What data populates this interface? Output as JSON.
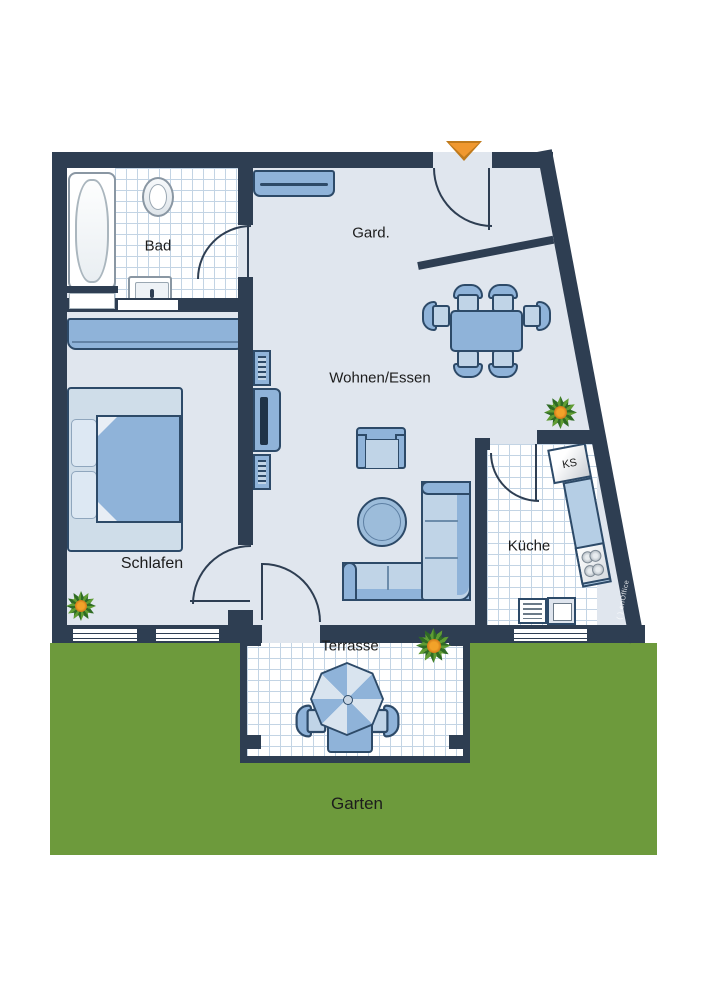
{
  "rooms": [
    {
      "id": "bad",
      "label": "Bad"
    },
    {
      "id": "gard",
      "label": "Gard."
    },
    {
      "id": "wohnen-essen",
      "label": "Wohnen/Essen"
    },
    {
      "id": "schlafen",
      "label": "Schlafen"
    },
    {
      "id": "kueche",
      "label": "Küche"
    },
    {
      "id": "terrasse",
      "label": "Terrasse"
    },
    {
      "id": "garten",
      "label": "Garten"
    }
  ],
  "labels": {
    "fridge": "KS",
    "watermark": "( ) enOffice"
  },
  "icons": {
    "entrance_marker": "down-triangle"
  },
  "colors": {
    "wall": "#2e3e52",
    "floor": "#e0e6ee",
    "tile_line": "#c3d4e4",
    "furniture": "#8fb3d9",
    "furniture_border": "#2d4a68",
    "furniture_light": "#c0d4e7",
    "furniture_lighter": "#dde8f3",
    "garden": "#6d9a3c",
    "entrance_arrow": "#f0982f",
    "text": "#1c1c1c"
  }
}
